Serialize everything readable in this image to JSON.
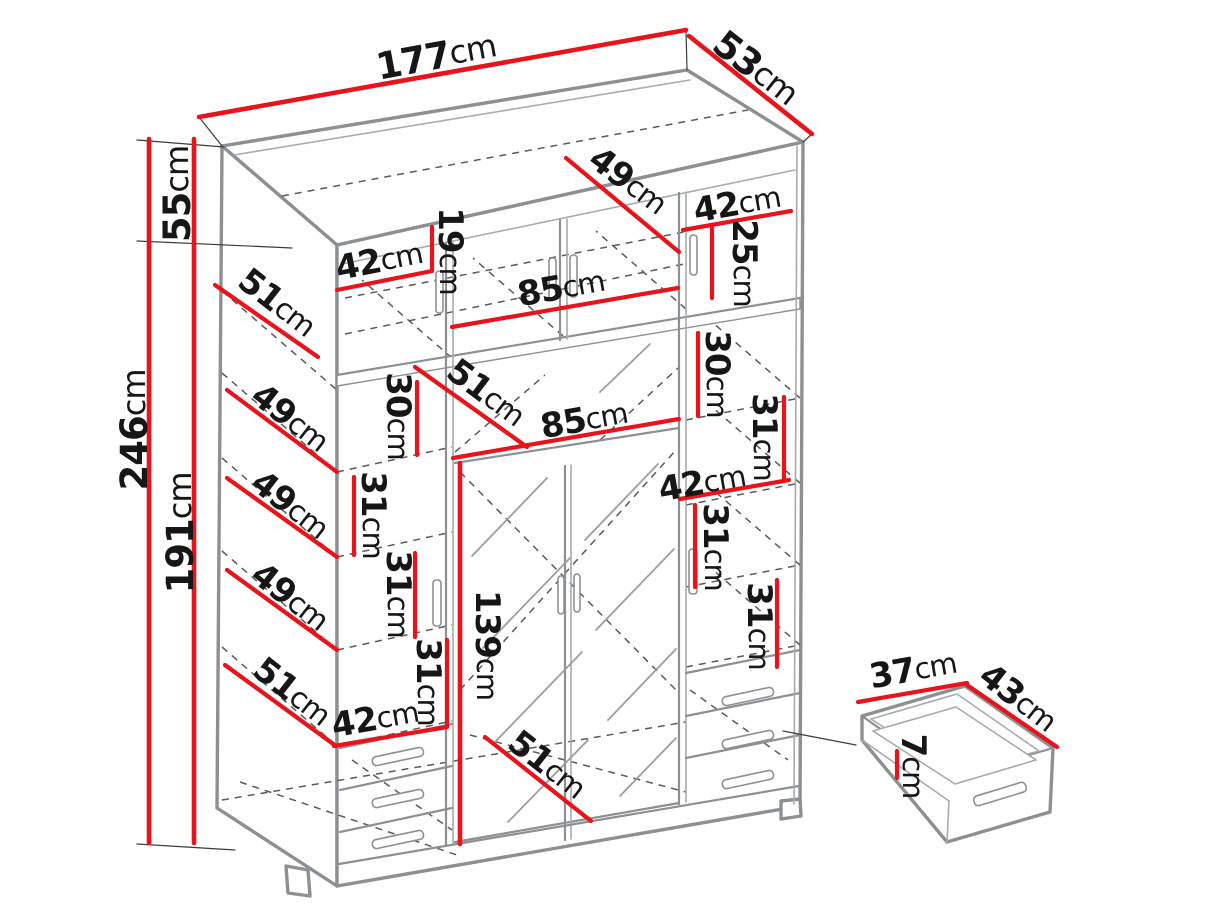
{
  "diagram": {
    "type": "furniture-dimension-diagram",
    "subject": "wardrobe-with-top-box-and-drawer-detail",
    "unit": "cm",
    "colors": {
      "dimension_red": "#e8131b",
      "outline_gray": "#8d9093",
      "dashed_gray": "#5a5a5a",
      "text_black": "#161616",
      "background": "#ffffff"
    },
    "labels": [
      {
        "id": "total-width",
        "num": "177",
        "unit": "cm",
        "x": 436,
        "y": 56,
        "rot": -10.5,
        "big": true
      },
      {
        "id": "total-depth",
        "num": "53",
        "unit": "cm",
        "x": 756,
        "y": 68,
        "rot": 38,
        "big": true
      },
      {
        "id": "top-shelf-depth",
        "num": "49",
        "unit": "cm",
        "x": 628,
        "y": 181,
        "rot": 37
      },
      {
        "id": "top-left-width",
        "num": "42",
        "unit": "cm",
        "x": 379,
        "y": 261,
        "rot": -11
      },
      {
        "id": "top-height-19",
        "num": "19",
        "unit": "cm",
        "x": 450,
        "y": 251,
        "rot": 90
      },
      {
        "id": "top-mid-width",
        "num": "85",
        "unit": "cm",
        "x": 561,
        "y": 288,
        "rot": -10
      },
      {
        "id": "top-right-width",
        "num": "42",
        "unit": "cm",
        "x": 737,
        "y": 204,
        "rot": -10
      },
      {
        "id": "top-height-25",
        "num": "25",
        "unit": "cm",
        "x": 744,
        "y": 263,
        "rot": 90
      },
      {
        "id": "side-depth-51-top",
        "num": "51",
        "unit": "cm",
        "x": 277,
        "y": 303,
        "rot": 38
      },
      {
        "id": "mid-depth-51",
        "num": "51",
        "unit": "cm",
        "x": 486,
        "y": 393,
        "rot": 37
      },
      {
        "id": "mid-height-30",
        "num": "30",
        "unit": "cm",
        "x": 398,
        "y": 416,
        "rot": 90
      },
      {
        "id": "mid-width-85",
        "num": "85",
        "unit": "cm",
        "x": 584,
        "y": 420,
        "rot": -10
      },
      {
        "id": "right-height-30",
        "num": "30",
        "unit": "cm",
        "x": 717,
        "y": 374,
        "rot": 90
      },
      {
        "id": "shelf-depth-49-1",
        "num": "49",
        "unit": "cm",
        "x": 290,
        "y": 418,
        "rot": 38
      },
      {
        "id": "shelf-depth-49-2",
        "num": "49",
        "unit": "cm",
        "x": 290,
        "y": 505,
        "rot": 38
      },
      {
        "id": "shelf-depth-49-3",
        "num": "49",
        "unit": "cm",
        "x": 290,
        "y": 597,
        "rot": 38
      },
      {
        "id": "shelf-depth-51-left",
        "num": "51",
        "unit": "cm",
        "x": 292,
        "y": 692,
        "rot": 38
      },
      {
        "id": "left-height-31-1",
        "num": "31",
        "unit": "cm",
        "x": 373,
        "y": 515,
        "rot": 90
      },
      {
        "id": "left-height-31-2",
        "num": "31",
        "unit": "cm",
        "x": 398,
        "y": 594,
        "rot": 90
      },
      {
        "id": "left-height-31-3",
        "num": "31",
        "unit": "cm",
        "x": 428,
        "y": 682,
        "rot": 90
      },
      {
        "id": "bottom-left-width",
        "num": "42",
        "unit": "cm",
        "x": 375,
        "y": 719,
        "rot": -10
      },
      {
        "id": "mirror-door-height",
        "num": "139",
        "unit": "cm",
        "x": 487,
        "y": 645,
        "rot": 90
      },
      {
        "id": "right-height-31-1",
        "num": "31",
        "unit": "cm",
        "x": 764,
        "y": 437,
        "rot": 90
      },
      {
        "id": "right-width-42",
        "num": "42",
        "unit": "cm",
        "x": 702,
        "y": 483,
        "rot": -10
      },
      {
        "id": "right-height-31-2",
        "num": "31",
        "unit": "cm",
        "x": 715,
        "y": 547,
        "rot": 90
      },
      {
        "id": "right-height-31-3",
        "num": "31",
        "unit": "cm",
        "x": 759,
        "y": 626,
        "rot": 90
      },
      {
        "id": "bottom-depth-51",
        "num": "51",
        "unit": "cm",
        "x": 547,
        "y": 765,
        "rot": 38
      },
      {
        "id": "total-height",
        "num": "246",
        "unit": "cm",
        "x": 134,
        "y": 430,
        "rot": -90,
        "big": true
      },
      {
        "id": "top-section-height",
        "num": "55",
        "unit": "cm",
        "x": 177,
        "y": 194,
        "rot": -90,
        "big": true
      },
      {
        "id": "main-section-height",
        "num": "191",
        "unit": "cm",
        "x": 180,
        "y": 533,
        "rot": -90,
        "big": true
      },
      {
        "id": "drawer-width",
        "num": "37",
        "unit": "cm",
        "x": 913,
        "y": 670,
        "rot": -10
      },
      {
        "id": "drawer-depth",
        "num": "43",
        "unit": "cm",
        "x": 1018,
        "y": 698,
        "rot": 38
      },
      {
        "id": "drawer-height",
        "num": "7",
        "unit": "cm",
        "x": 913,
        "y": 766,
        "rot": 90
      }
    ]
  }
}
